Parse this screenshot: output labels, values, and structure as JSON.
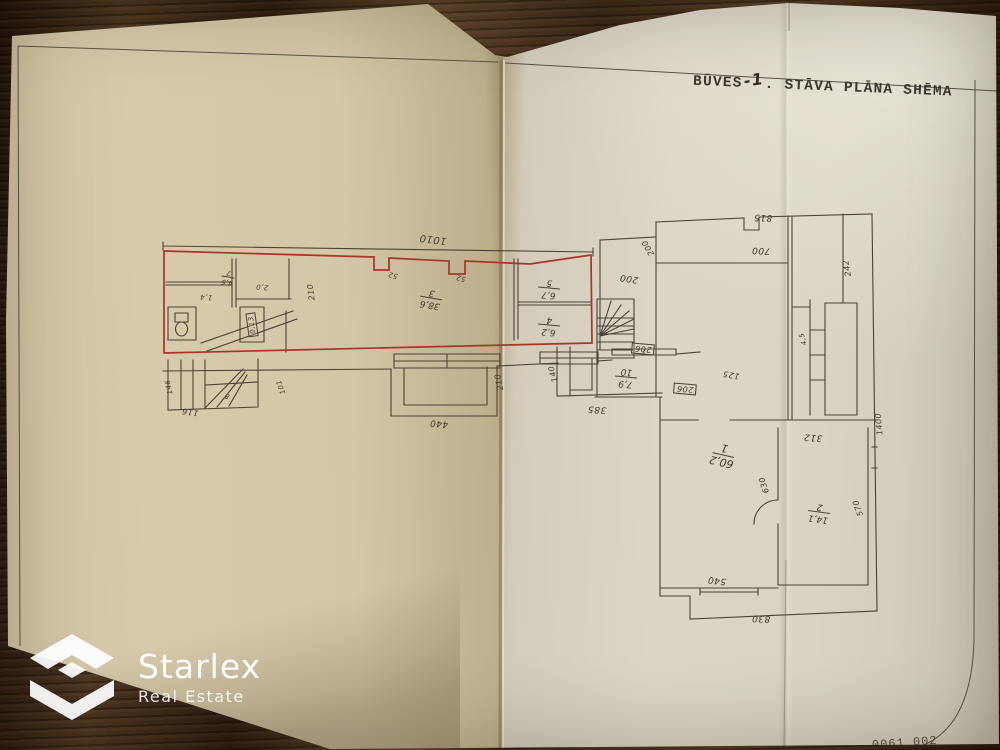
{
  "title": {
    "prefix": "BŪVES",
    "floor": "-1",
    "suffix": ". STĀVA PLĀNA SHĒMA"
  },
  "doc_code": "0061  002",
  "brand": {
    "name": "Starlex",
    "tagline": "Real Estate"
  },
  "colors": {
    "paper": "#d6cab0",
    "ink": "#4b4237",
    "red_outline": "#a93428",
    "wood": "#3a2715"
  },
  "plan": {
    "rooms": [
      {
        "num": "7",
        "area": "4,5",
        "x": 228,
        "y": 277,
        "r": 190,
        "cls": "sm"
      },
      {
        "num": "3",
        "area": "38,6",
        "x": 431,
        "y": 298,
        "r": 190,
        "cls": ""
      },
      {
        "num": "5",
        "area": "6,7",
        "x": 549,
        "y": 288,
        "r": 185,
        "cls": ""
      },
      {
        "num": "4",
        "area": "6,2",
        "x": 549,
        "y": 325,
        "r": 185,
        "cls": ""
      },
      {
        "num": "10",
        "area": "7,9",
        "x": 626,
        "y": 377,
        "r": 185,
        "cls": ""
      },
      {
        "num": "1",
        "area": "60,2",
        "x": 723,
        "y": 455,
        "r": 193,
        "cls": "big"
      },
      {
        "num": "2",
        "area": "14,1",
        "x": 819,
        "y": 512,
        "r": 188,
        "cls": ""
      }
    ],
    "dims": [
      {
        "t": "1010",
        "x": 433,
        "y": 239,
        "r": 187,
        "s": 10
      },
      {
        "t": "52",
        "x": 393,
        "y": 275,
        "r": 195,
        "s": 7
      },
      {
        "t": "52",
        "x": 461,
        "y": 278,
        "r": 195,
        "s": 7
      },
      {
        "t": "210",
        "x": 311,
        "y": 292,
        "r": 262,
        "s": 8
      },
      {
        "t": "1,4",
        "x": 206,
        "y": 297,
        "r": 185,
        "s": 7
      },
      {
        "t": "2,0",
        "x": 262,
        "y": 287,
        "r": 185,
        "s": 7
      },
      {
        "t": "146",
        "x": 169,
        "y": 387,
        "r": 258,
        "s": 7
      },
      {
        "t": "116",
        "x": 190,
        "y": 412,
        "r": 188,
        "s": 8
      },
      {
        "t": "101",
        "x": 281,
        "y": 387,
        "r": 250,
        "s": 7
      },
      {
        "t": "8",
        "x": 227,
        "y": 396,
        "r": 200,
        "s": 7
      },
      {
        "t": "440",
        "x": 439,
        "y": 423,
        "r": 185,
        "s": 9
      },
      {
        "t": "210",
        "x": 499,
        "y": 382,
        "r": 258,
        "s": 8
      },
      {
        "t": "140",
        "x": 553,
        "y": 374,
        "r": 255,
        "s": 8
      },
      {
        "t": "385",
        "x": 597,
        "y": 409,
        "r": 184,
        "s": 9
      },
      {
        "t": "200",
        "x": 629,
        "y": 278,
        "r": 188,
        "s": 9
      },
      {
        "t": "200",
        "x": 648,
        "y": 248,
        "r": 240,
        "s": 8
      },
      {
        "t": "815",
        "x": 763,
        "y": 217,
        "r": 182,
        "s": 9
      },
      {
        "t": "700",
        "x": 761,
        "y": 250,
        "r": 183,
        "s": 9
      },
      {
        "t": "242",
        "x": 847,
        "y": 268,
        "r": 260,
        "s": 8
      },
      {
        "t": "4,5",
        "x": 803,
        "y": 339,
        "r": 255,
        "s": 7
      },
      {
        "t": "312",
        "x": 813,
        "y": 437,
        "r": 184,
        "s": 9
      },
      {
        "t": "630",
        "x": 764,
        "y": 485,
        "r": 252,
        "s": 8
      },
      {
        "t": "125",
        "x": 731,
        "y": 375,
        "r": 190,
        "s": 8
      },
      {
        "t": "570",
        "x": 858,
        "y": 508,
        "r": 250,
        "s": 8
      },
      {
        "t": "1400",
        "x": 879,
        "y": 424,
        "r": 265,
        "s": 8
      },
      {
        "t": "540",
        "x": 717,
        "y": 580,
        "r": 186,
        "s": 9
      },
      {
        "t": "830",
        "x": 761,
        "y": 618,
        "r": 182,
        "s": 9
      }
    ],
    "boxes": [
      {
        "t": "0,13",
        "x": 252,
        "y": 325,
        "r": 262,
        "s": 7
      },
      {
        "t": "206",
        "x": 643,
        "y": 349,
        "r": 185,
        "s": 8
      },
      {
        "t": "206",
        "x": 685,
        "y": 389,
        "r": 185,
        "s": 8
      }
    ]
  }
}
